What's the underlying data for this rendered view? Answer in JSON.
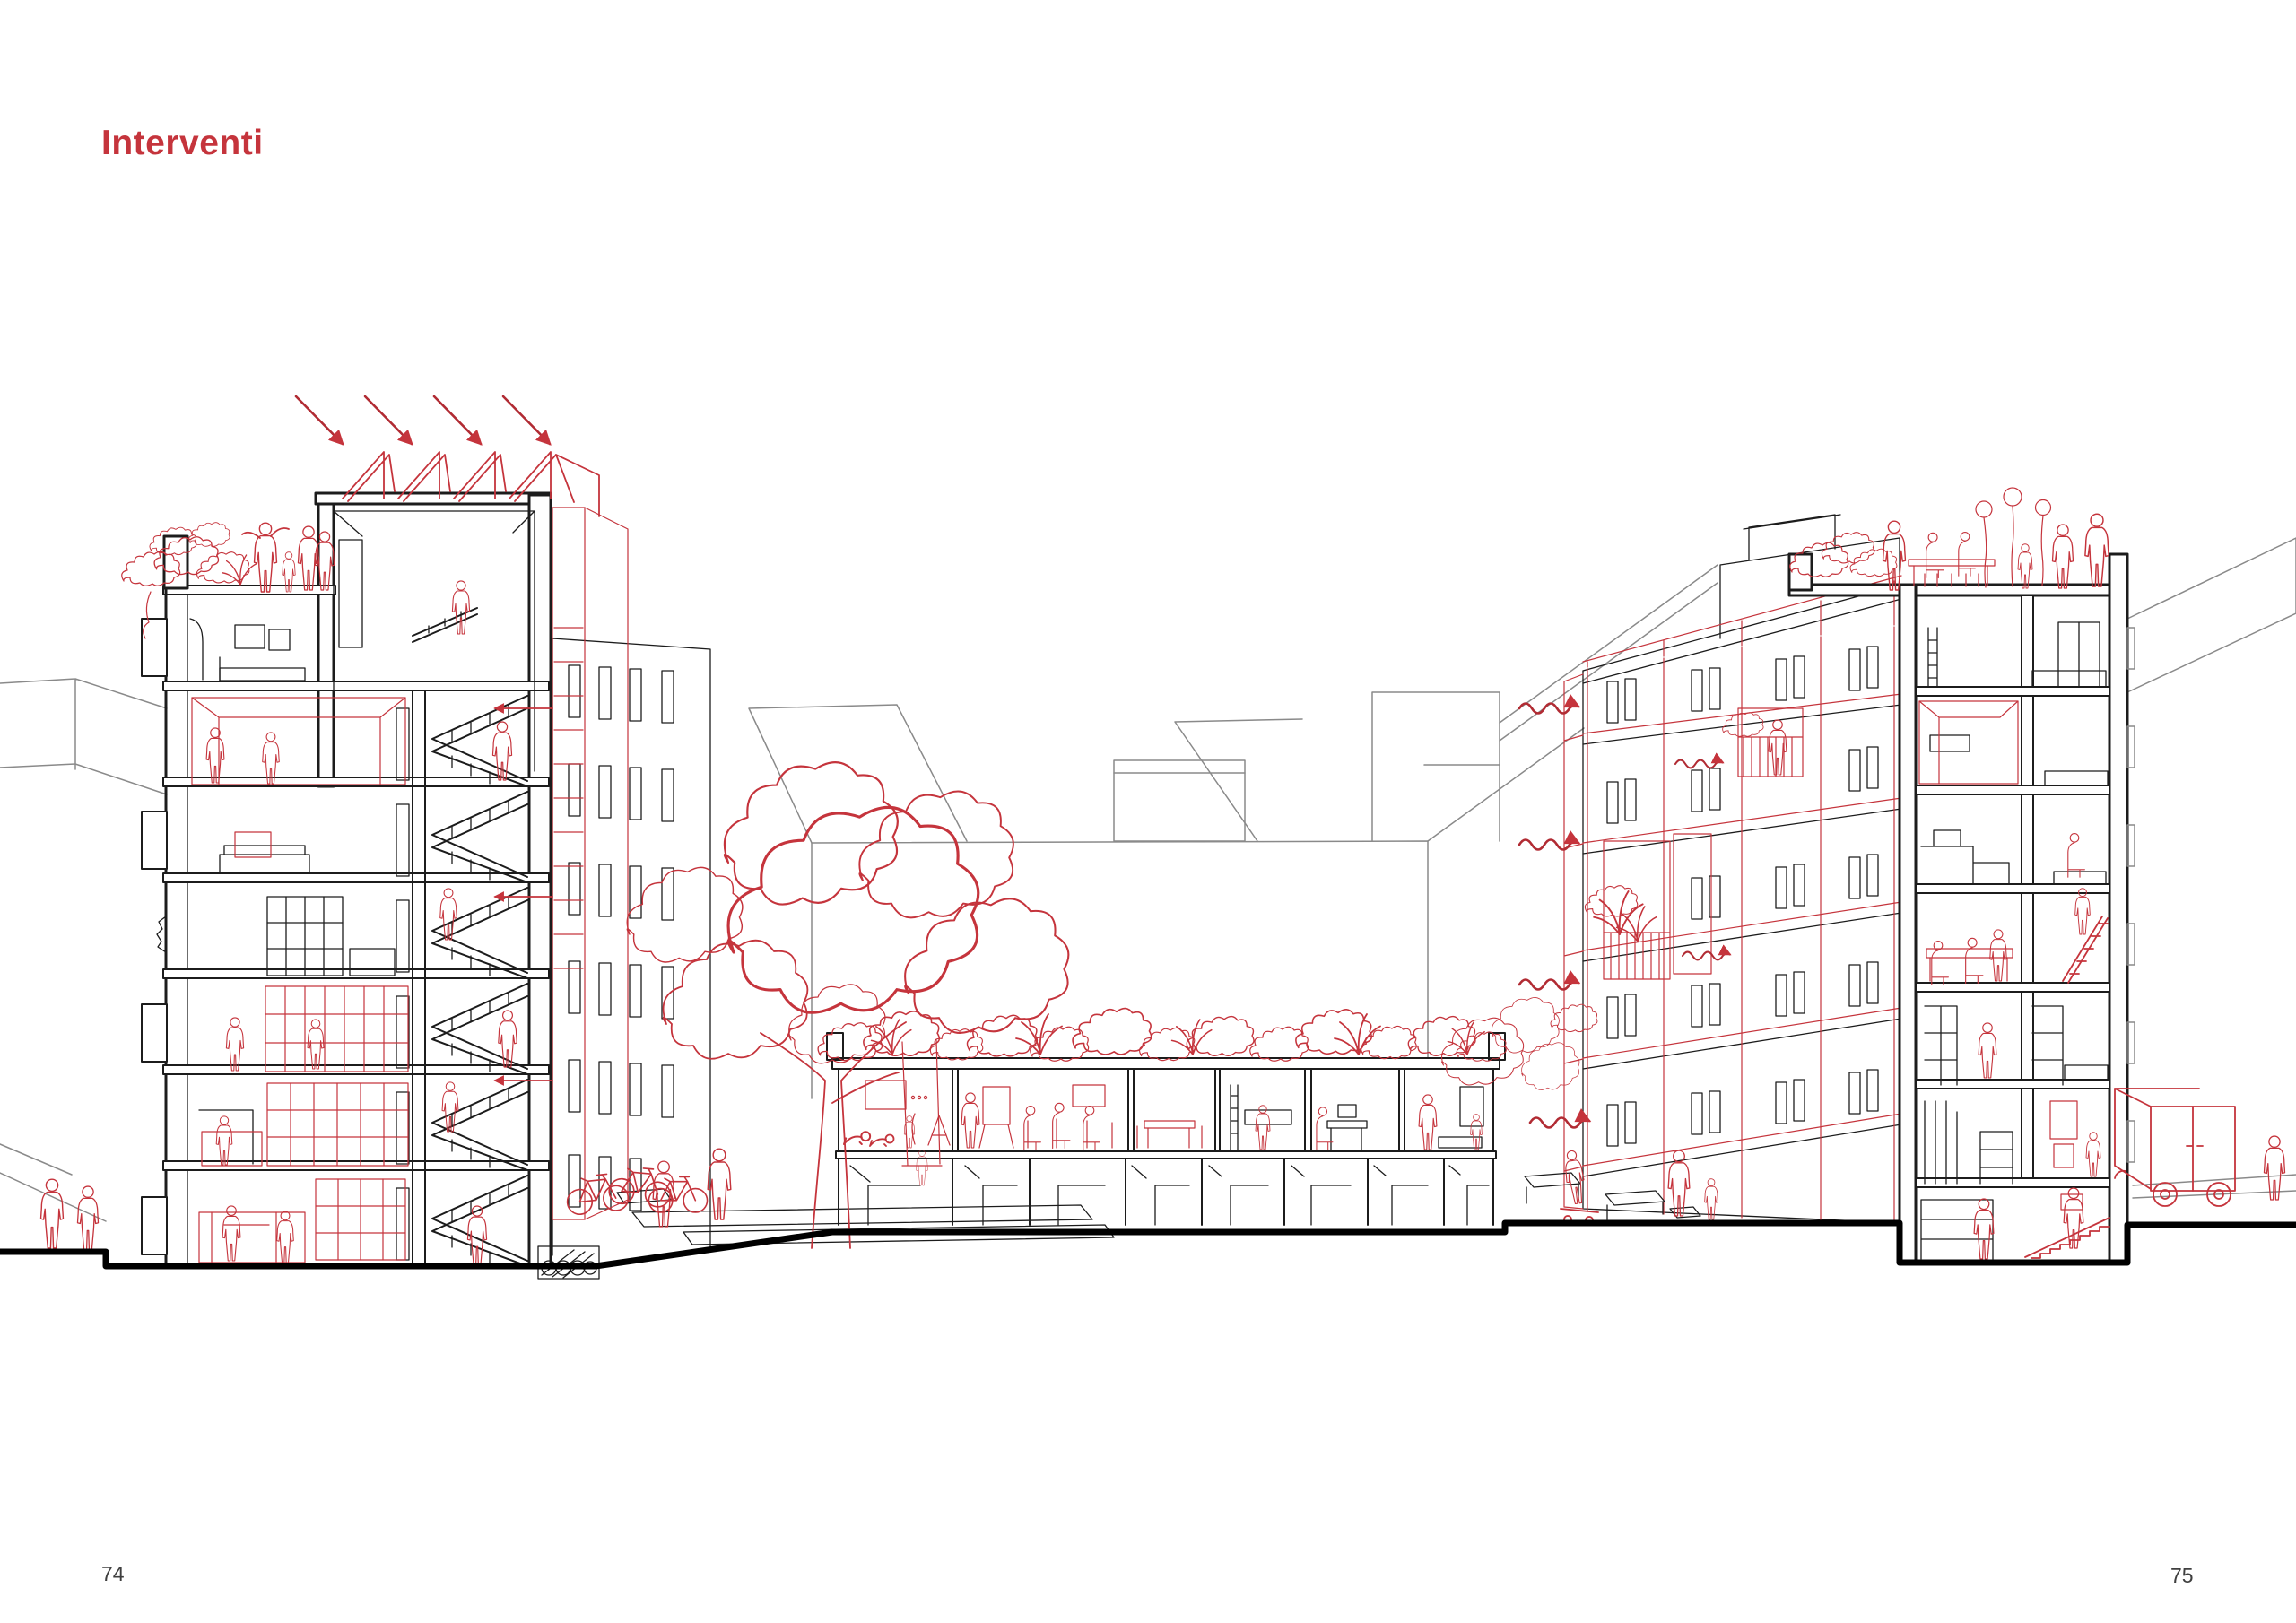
{
  "page": {
    "title": "Interventi",
    "page_number_left": "74",
    "page_number_right": "75"
  },
  "colors": {
    "accent": "#c5343c",
    "ink": "#1c1c1c",
    "background_line": "#8a8a8a",
    "paper": "#ffffff",
    "page_number": "#3f3f3f"
  },
  "figure": {
    "type": "architectural-section-drawing",
    "elements": [
      "left-building-section",
      "solar-panels",
      "sun-arrows",
      "roof-terrace-left",
      "staircase",
      "ventilation-shaft",
      "courtyard-tree",
      "tree-swing",
      "bicycles",
      "underground-pipes-icon",
      "green-roof-pavilion",
      "courtyard-back-wall",
      "right-facade-renovation-grid",
      "balconies",
      "breeze-arrows",
      "right-building-section",
      "roof-terrace-right",
      "balloons",
      "entry-stairs",
      "delivery-van",
      "street",
      "people"
    ]
  }
}
